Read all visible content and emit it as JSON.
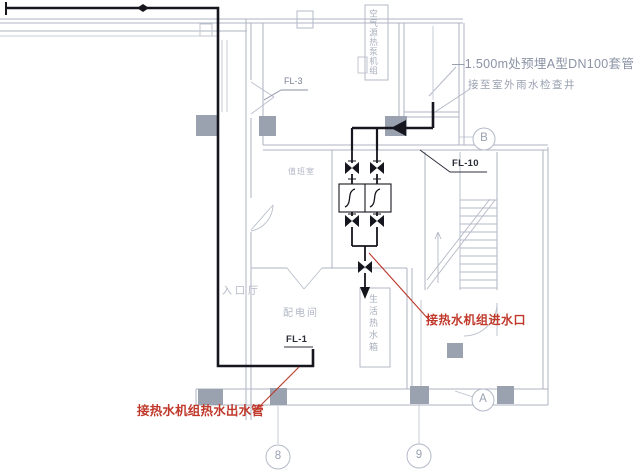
{
  "annotations": {
    "elevation_note": "—1.500m处预埋A型DN100套管",
    "drain_note": "接至室外雨水检查井",
    "outlet_note": "接热水机组热水出水管",
    "inlet_note": "接热水机组进水口"
  },
  "pipe_labels": {
    "fl1": "FL-1",
    "fl3": "FL-3",
    "fl10": "FL-10"
  },
  "grid_bubbles": {
    "col_8": "8",
    "col_9": "9",
    "row_a": "A",
    "row_b": "B"
  },
  "room_labels": {
    "duty_room": "值班室",
    "entrance_hall": "入口厅",
    "power_room": "配电间",
    "equipment_box": "空气源热泵机组",
    "tank_box": "生活热水箱"
  },
  "colors": {
    "pipe_black": "#16161e",
    "annotation_red": "#c0392b",
    "line_gray": "#adb4c2",
    "text_gray": "#8b93a5"
  }
}
